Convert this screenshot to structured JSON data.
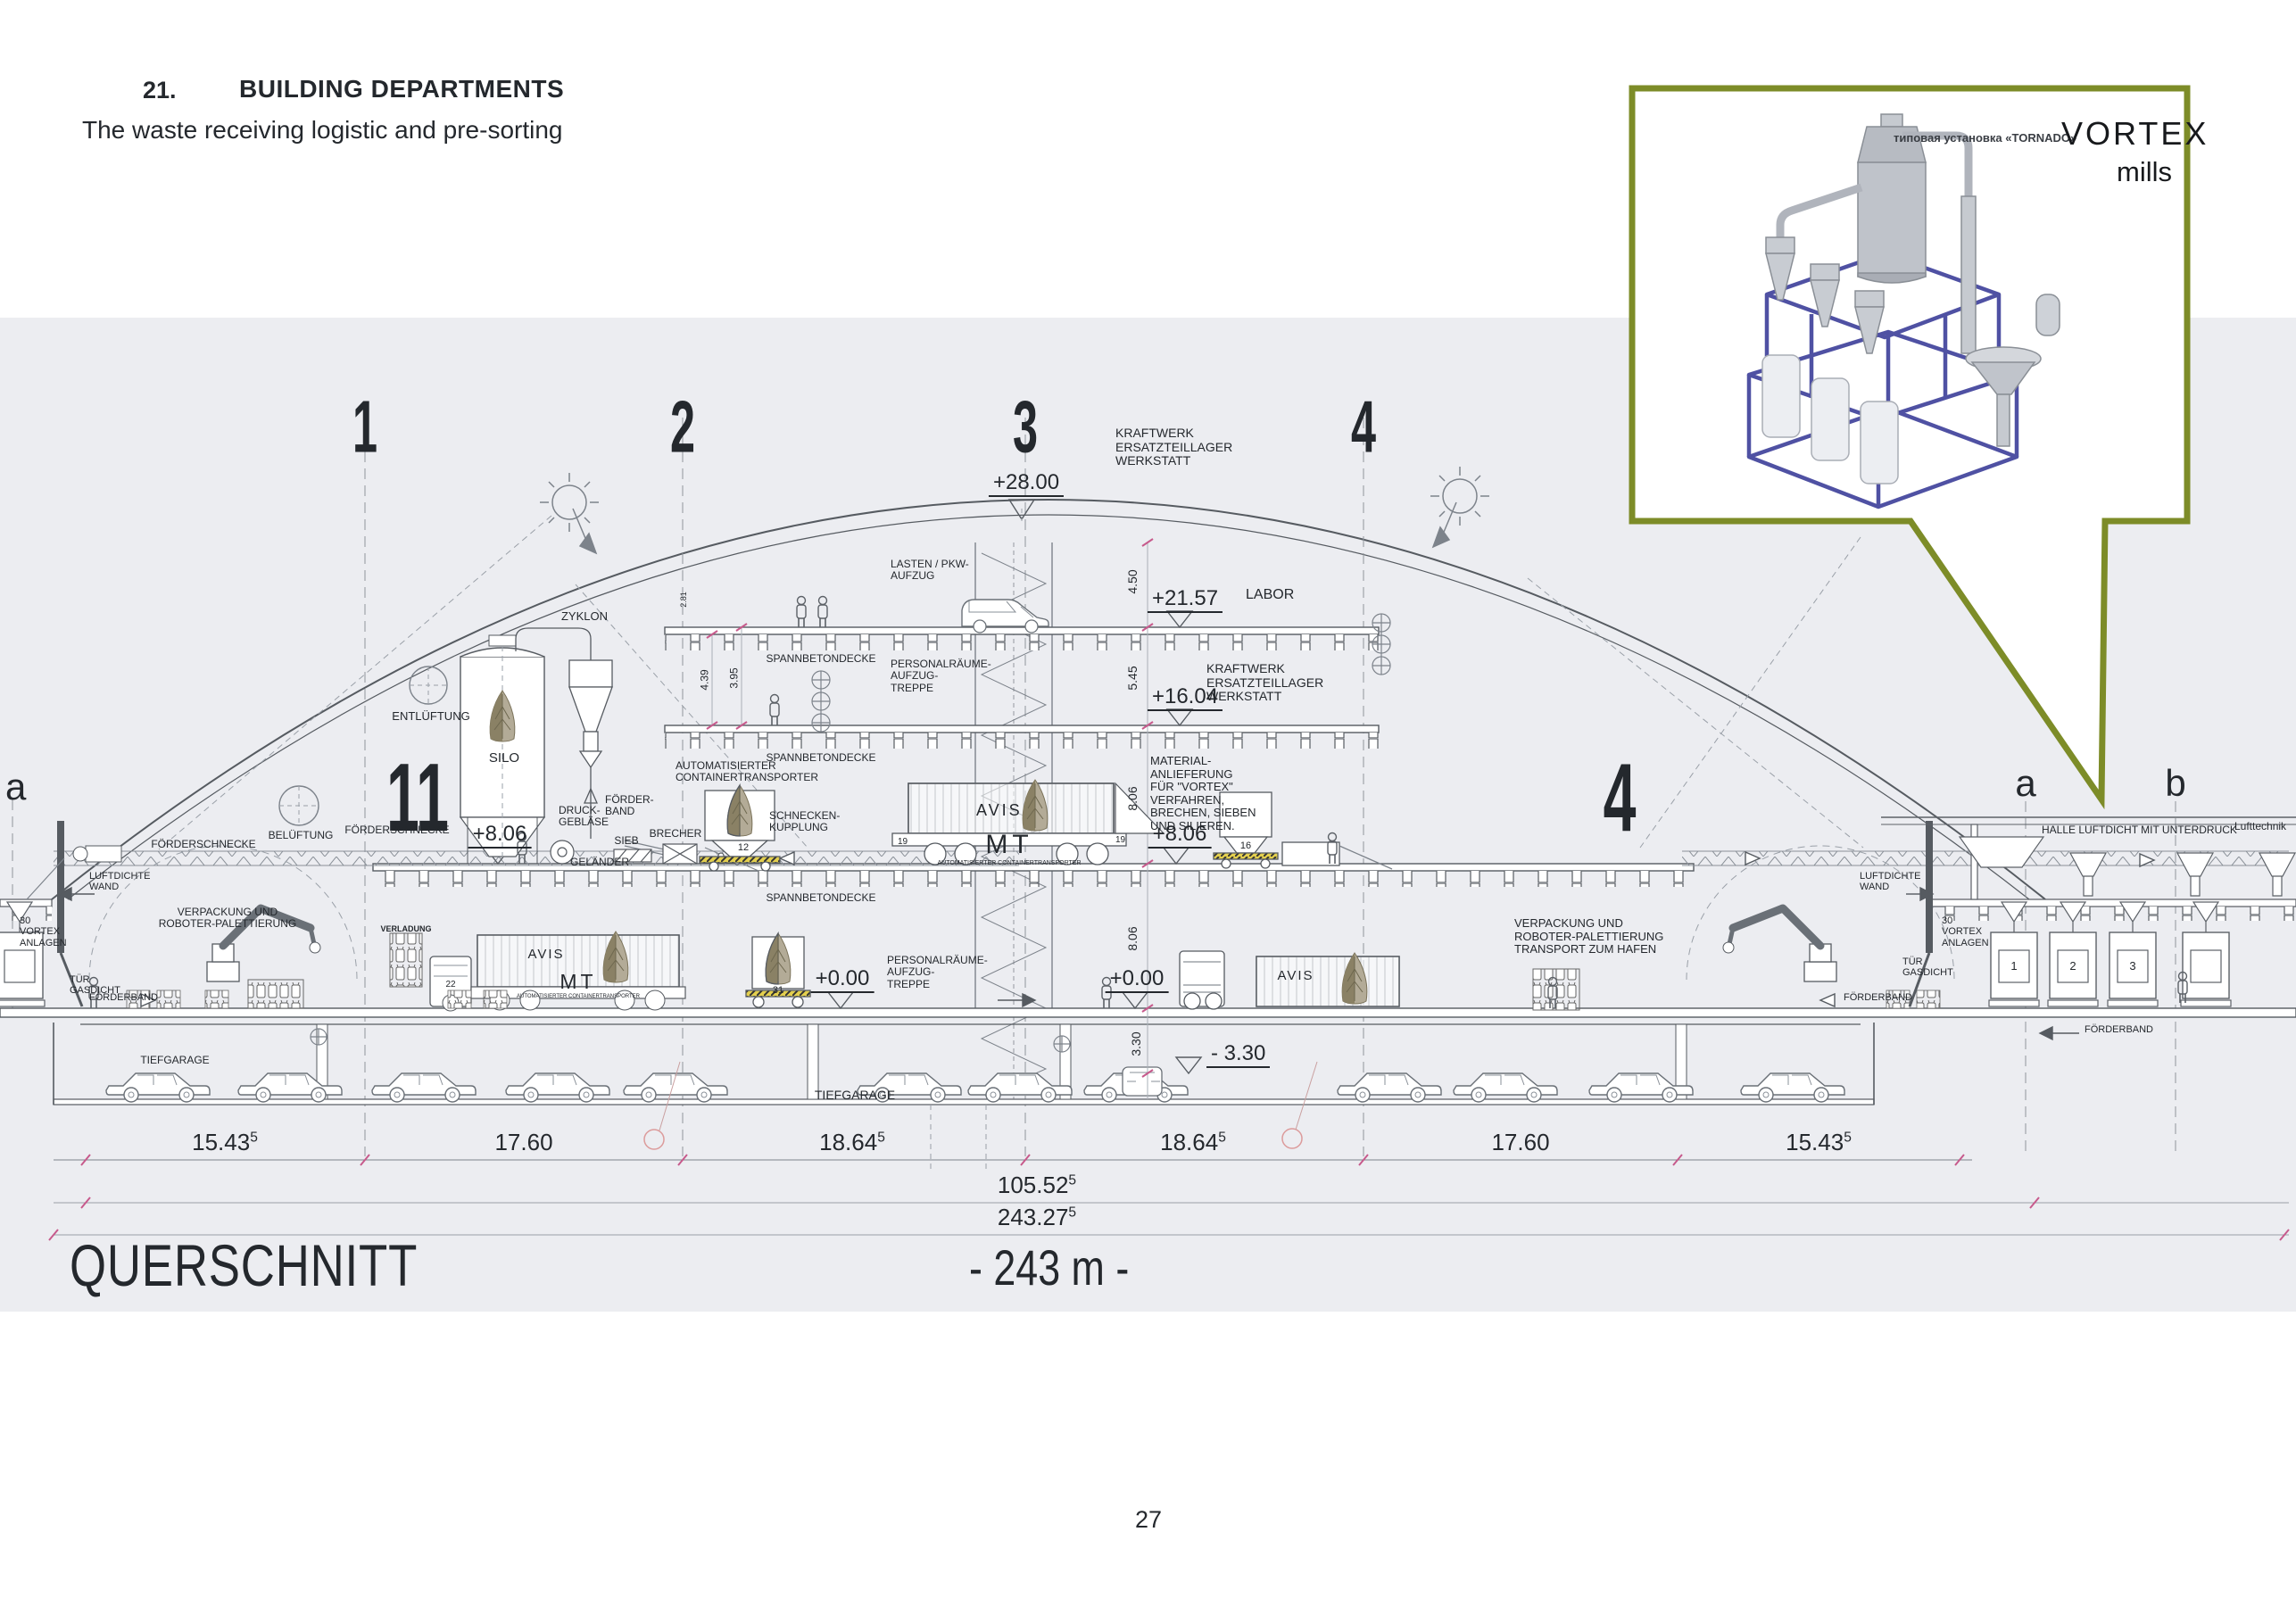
{
  "page": {
    "number": "27"
  },
  "header": {
    "section_number": "21.",
    "title": "BUILDING DEPARTMENTS",
    "subtitle": "The waste receiving logistic and pre-sorting"
  },
  "inset": {
    "caption": "типовая установка «TORNADO»",
    "brand": "VORTEX",
    "brand_sub": "mills"
  },
  "colors": {
    "band": "#ecedf1",
    "callout_border": "#7d8c28",
    "machine_frame_blue": "#4f51a3",
    "tick_magenta": "#c75a8c"
  },
  "drawing": {
    "title": "QUERSCHNITT",
    "total_span": "- 243 m -",
    "grid": {
      "n1": "1",
      "n2": "2",
      "n3": "3",
      "n4": "4",
      "a": "a",
      "b": "b",
      "bay_left": "11",
      "bay_right": "4"
    },
    "levels": {
      "roof": "+28.00",
      "f3": "+21.57",
      "f2": "+16.04",
      "f1": "+8.06",
      "ground": "+0.00",
      "basement": "- 3.30"
    },
    "heights": {
      "h450": "4.50",
      "h545": "5.45",
      "h806": "8.06",
      "h439": "4.39",
      "h395": "3.95",
      "h330": "3.30",
      "h281": "2.81"
    },
    "dims": {
      "d1": "15.43",
      "d2": "17.60",
      "d3": "18.64",
      "d4": "18.64",
      "d5": "17.60",
      "d6": "15.43",
      "sub_total": "105.52",
      "total": "243.27",
      "sup": "5"
    },
    "ids": {
      "c12": "12",
      "c16": "16",
      "c31": "31",
      "t22": "22",
      "w19": "19",
      "u1": "1",
      "u2": "2",
      "u3": "3"
    },
    "brand": {
      "avis": "AVIS",
      "mt": "MT",
      "mt_sub": "AUTOMATISIERTER CONTAINERTRANSPORTER"
    },
    "labels": {
      "kraftwerk": "KRAFTWERK\nERSATZTEILLAGER\nWERKSTATT",
      "labor": "LABOR",
      "lasten": "LASTEN / PKW-\nAUFZUG",
      "personal": "PERSONALRÄUME-\nAUFZUG-\nTREPPE",
      "spannbeton": "SPANNBETONDECKE",
      "zyklon": "ZYKLON",
      "entlueftung": "ENTLÜFTUNG",
      "belueftung": "BELÜFTUNG",
      "silo": "SILO",
      "foerderschnecke": "FÖRDERSCHNECKE",
      "gelaender": "GELÄNDER",
      "druckgeblaese": "DRUCK-\nGEBLÄSE",
      "foerderband_2line": "FÖRDER-\nBAND",
      "sieb": "SIEB",
      "brecher": "BRECHER",
      "schneckenkupplung": "SCHNECKEN-\nKUPPLUNG",
      "autotransporter": "AUTOMATISIERTER\nCONTAINERTRANSPORTER",
      "material": "MATERIAL-\nANLIEFERUNG\nFÜR \"VORTEX\"\nVERFAHREN,\nBRECHEN, SIEBEN\nUND SILIEREN.",
      "verpackung": "VERPACKUNG UND\nROBOTER-PALETTIERUNG",
      "verpackung_hafen": "VERPACKUNG UND\nROBOTER-PALETTIERUNG\nTRANSPORT ZUM HAFEN",
      "verladung": "VERLADUNG",
      "halle": "HALLE LUFTDICHT MIT UNTERDRUCK",
      "lufttechnik": "Lufttechnik",
      "luftdichte_wand": "LUFTDICHTE\nWAND",
      "tuer_gasdicht": "TÜR\nGASDICHT",
      "vortex_anlagen": "30\nVORTEX\nANLAGEN",
      "foerderband": "FÖRDERBAND",
      "tiefgarage": "TIEFGARAGE"
    }
  }
}
